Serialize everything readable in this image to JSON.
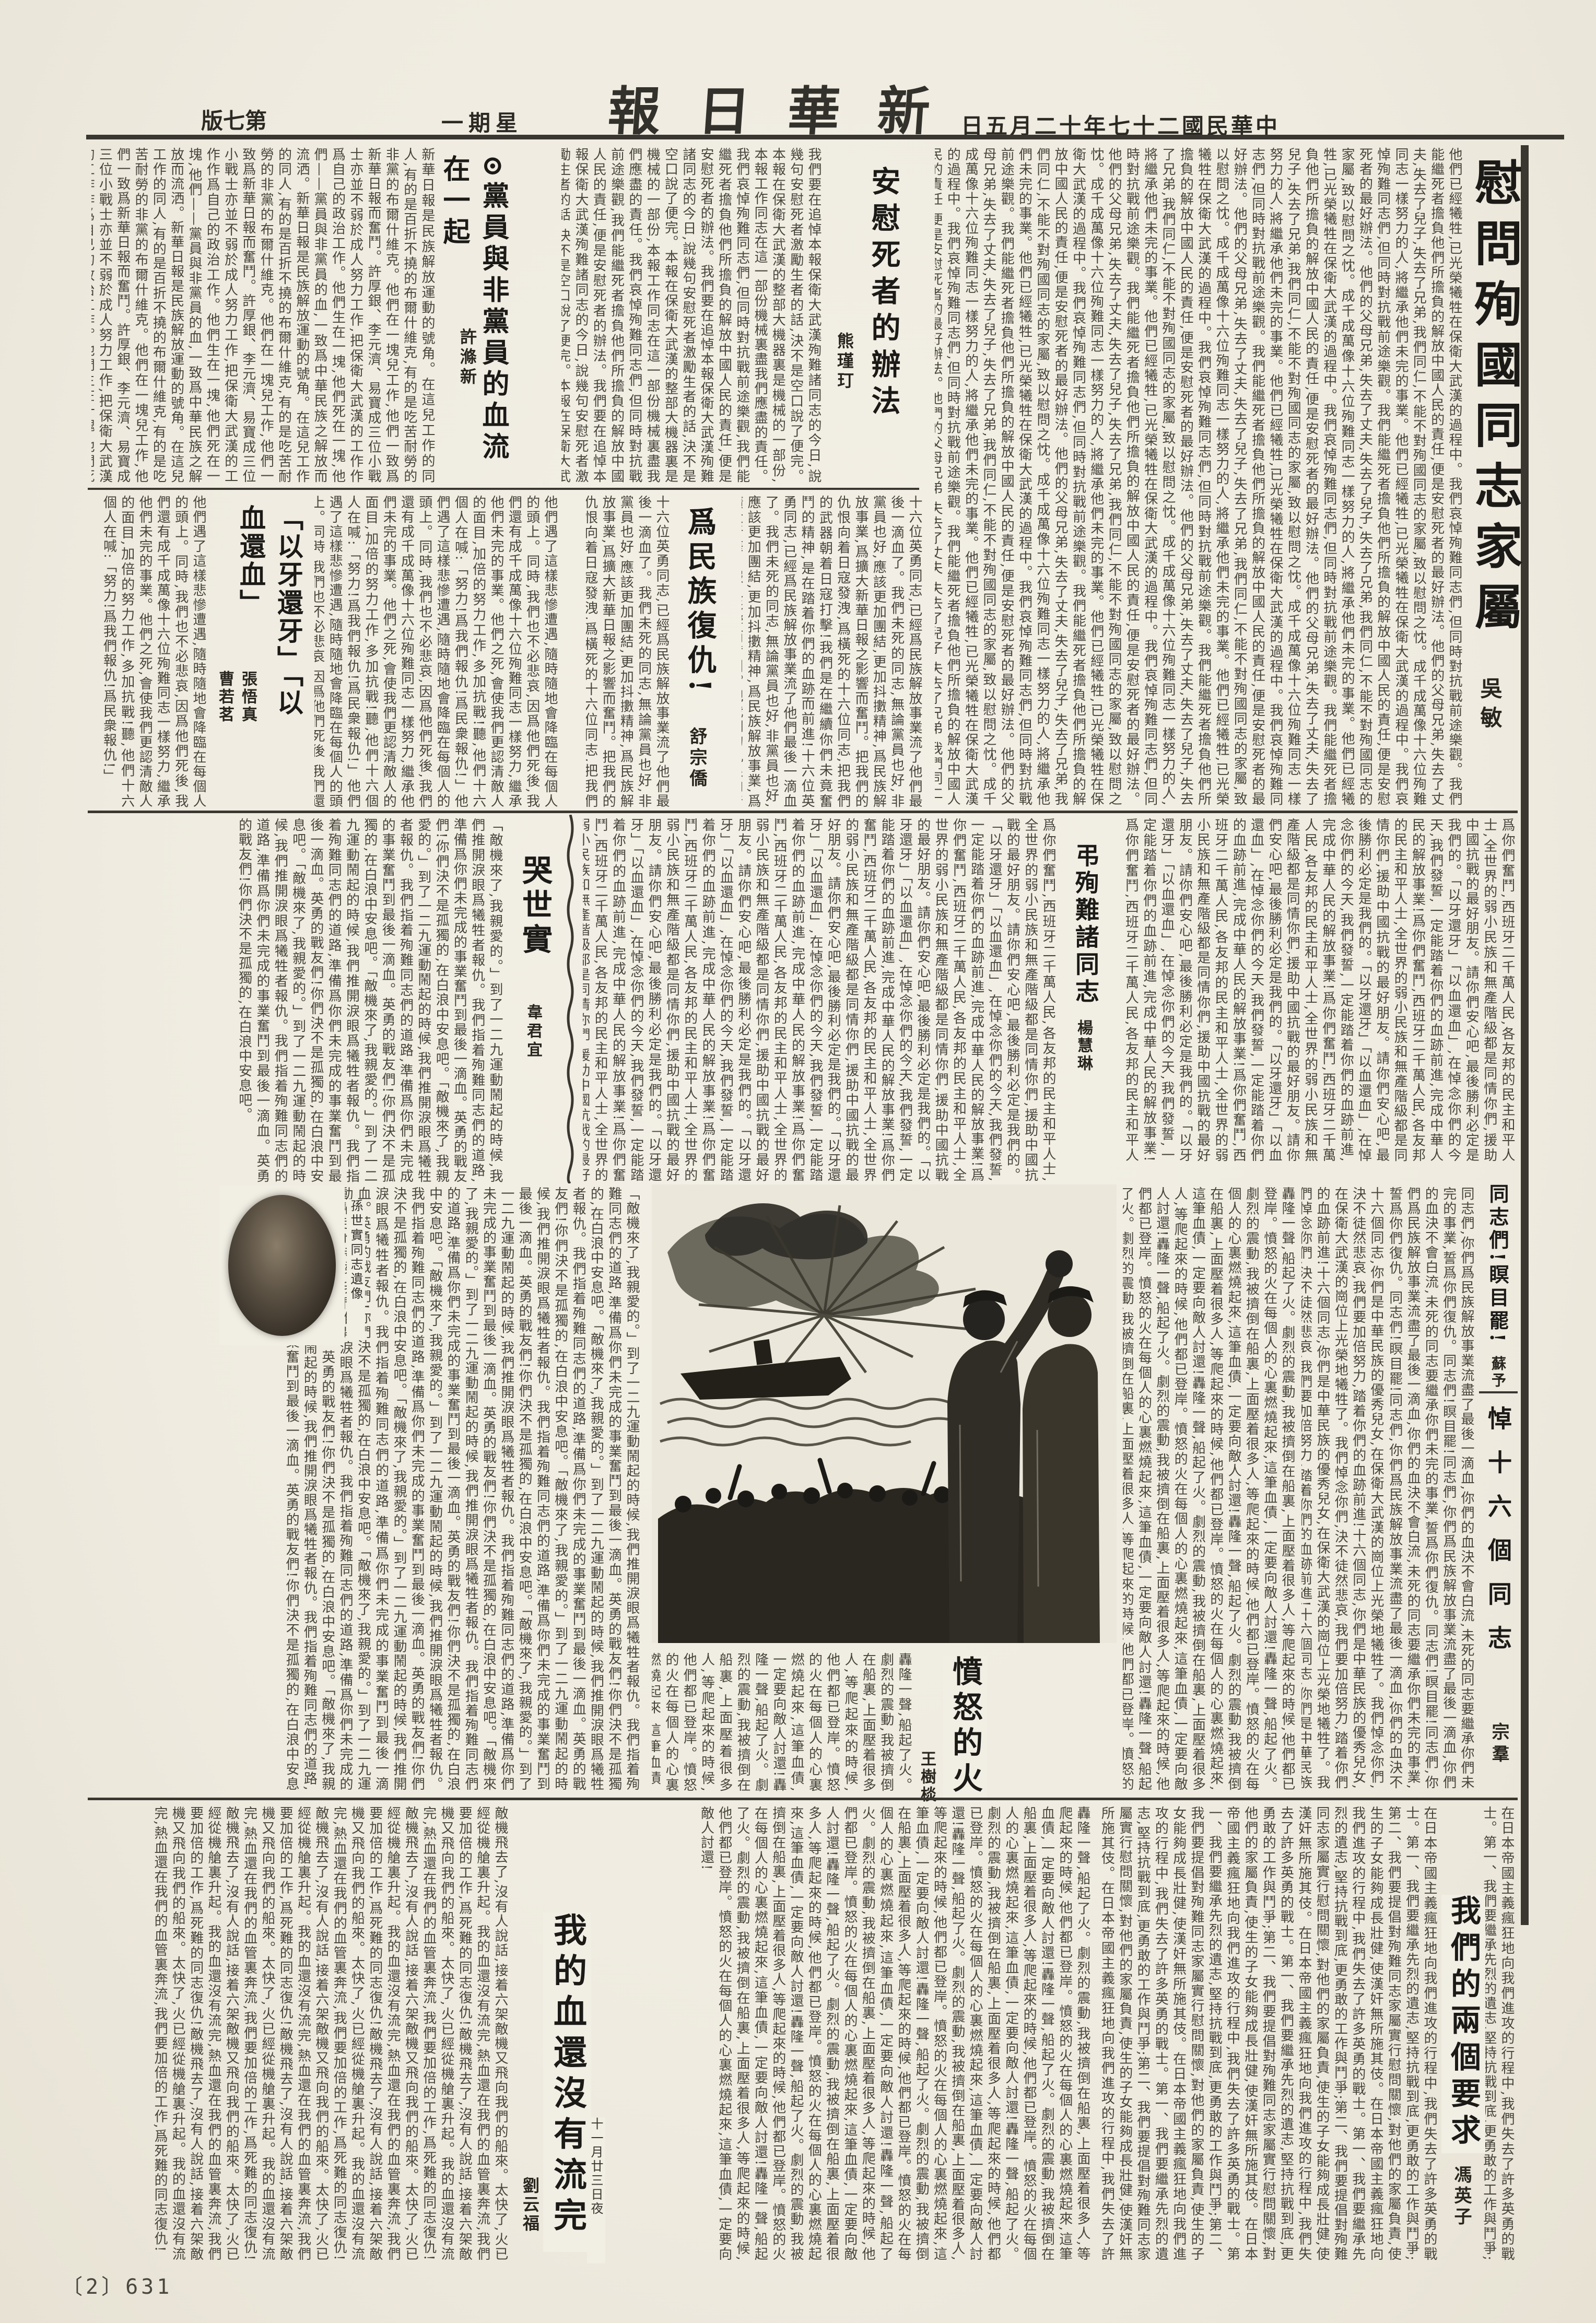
{
  "masthead": {
    "paper_name": "新華日報",
    "date": "中華民國二十七年十二月五日",
    "weekday": "星期一",
    "edition": "第七版"
  },
  "page_footer": {
    "page_number": "〔2〕631"
  },
  "images": {
    "portrait_caption": "孫世實同志遺像",
    "illustration_alt": "保衛大武漢殉難紀念木刻畫"
  },
  "articles": {
    "weiwen": {
      "title": "慰問殉國同志家屬",
      "author": "吳敏",
      "excerpt": "他們已經犧牲,已光榮犧牲在保衛大武漢的過程中。我們哀悼殉難同志們,但同時對抗戰前途樂觀。我們能繼死者擔負他們所擔負的解放中國人民的責任,便是安慰死者的最好辦法。他們的父母兄弟,失去了丈夫,失去了兒子,失去了兄弟,我們同仁,不能不對殉國同志的家屬,致以慰問之忱。成千成萬像十六位殉難同志一樣努力的人,將繼承他們未完的事業。"
    },
    "anwei": {
      "title": "安慰死者的辦法",
      "author": "熊瑾玎",
      "excerpt": "我們要在追悼本報保衛大武漢殉難諸同志的今日,說幾句安慰死者激勵生者的話,決不是空口說了便完。本報在保衛大武漢的整部大機器裏是機械的一部份,本報工作同志在這一部份機械裏盡我們應盡的責任。我們哀悼殉難同志們,但同時對抗戰前途樂觀,我們能繼死者擔負他們所擔負的解放中國人民的責任,便是安慰死者的辦法。"
    },
    "dangyuan": {
      "title": "⊙黨員與非黨員的血流在一起",
      "author": "許滌新",
      "excerpt": "新華日報是民族解放運動的號角。在這兒工作的同人,有的是百折不撓的布爾什維克,有的是吃苦耐勞的非黨的布爾什維克。他們在一塊兒工作,他們一致爲新華日報而奮鬥。許厚銀、李元濟、易寶成三位小戰士亦並不弱於成人努力工作,把保衛大武漢的工作作爲自己的政治工作。他們生在一塊,他們死在一塊,他們——黨員與非黨員的血,一致爲中華民族之解放而流洒。"
    },
    "fuchou": {
      "title": "爲民族復仇!",
      "author": "舒宗僑",
      "excerpt": "十六位英勇同志,已經爲民族解放事業流了他們最後一滴血了。我們未死的同志,無論黨員也好,非黨員也好,應該更加團結,更加抖擻精神,爲民族解放事業,爲擴大新華日報之影響而奮鬥。把我們的仇恨向着日寇發洩,爲橫死的十六位同志,把我們的武器朝着日寇打擊!我們是在繼續你們未竟奮鬥的精神,是在踏着你們的血跡而前進!"
    },
    "yiya": {
      "title": "「以牙還牙」「以血還血」",
      "authors": "張悟真曹若茗",
      "excerpt": "他們遇了這樣悲慘遭遇,隨時隨地會降臨在每個人的頭上。同時,我們也不必悲哀,因爲他們死後,我們還有成千成萬像十六位殉難同志一樣努力,繼承他們未完的事業。他們之死,會使我們更認清敵人的面目,加倍的努力工作,多加抗戰!聽,他們十六個人在喊:「努力!爲我們報仇!爲民衆報仇!」"
    },
    "kushi": {
      "title": "哭世實",
      "author": "韋君宜",
      "excerpt": "「敵機來了,我親愛的。」到了一二九運動鬧起的時候,我們推開淚眼爲犧牲者報仇。我們指着殉難同志們的道路,準備爲你們未完成的事業奮鬥到最後一滴血。英勇的戰友們!你們決不是孤獨的,在白浪中安息吧。"
    },
    "diaoxun": {
      "title": "弔殉難諸同志",
      "author": "楊慧琳",
      "excerpt": "爲你們奮鬥,西班牙二千萬人民,各友邦的民主和平人士,全世界的弱小民族和無產階級都是同情你們,援助中國抗戰的最好朋友。請你們安心吧,最後勝利必定是我們的。「以牙還牙」「以血還血」,在悼念你們的今天,我們發誓,一定能踏着你們的血跡前進,完成中華人民的解放事業!"
    },
    "tongzhimen": {
      "title": "同志們!瞑目罷!",
      "author": "蘇予",
      "excerpt": "同志們,你們爲民族解放事業流盡了最後一滴血,你們的血決不會白流,未死的同志要繼承你們未完的事業,誓爲你們復仇。同志們!瞑目罷!"
    },
    "dao16": {
      "title": "悼十六個同志",
      "author": "宗羣",
      "excerpt": "十六個同志,你們是中華民族的優秀兒女,在保衛大武漢的崗位上光榮地犧牲了。我們悼念你們,決不徒然悲哀,我們要加倍努力,踏着你們的血跡前進!"
    },
    "fennu": {
      "title": "憤怒的火",
      "author": "王樹棪",
      "excerpt": "轟隆一聲,船起了火。劇烈的震動,我被擠倒在船裏,上面壓着很多人,等爬起來的時候,他們都已登岸。憤怒的火在每個人的心裏燃燒起來,這筆血債,一定要向敵人討還!"
    },
    "wodexue": {
      "title": "我的血還沒有流完",
      "author": "劉云福",
      "date_note": "十一月廿三日夜",
      "excerpt": "敵機飛去了,沒有人說話,接着六架敵機又飛向我們的船來。太快了,火已經從機艙裏升起。我的血還沒有流完,熱血還在我們的血管裏奔流,我們要加倍的工作,爲死難的同志復仇!"
    },
    "liangge": {
      "title": "我們的兩個要求",
      "author": "馮英子",
      "excerpt": "在日本帝國主義瘋狂地向我們進攻的行程中,我們失去了許多英勇的戰士。第一、我們要繼承先烈的遺志,堅持抗戰到底,更勇敢的工作與鬥爭;第二、我們要提倡對殉難同志家屬實行慰問關懷,對他們的家屬負責,使生的子女能夠成長壯健,使漢奸無所施其伎。"
    }
  }
}
